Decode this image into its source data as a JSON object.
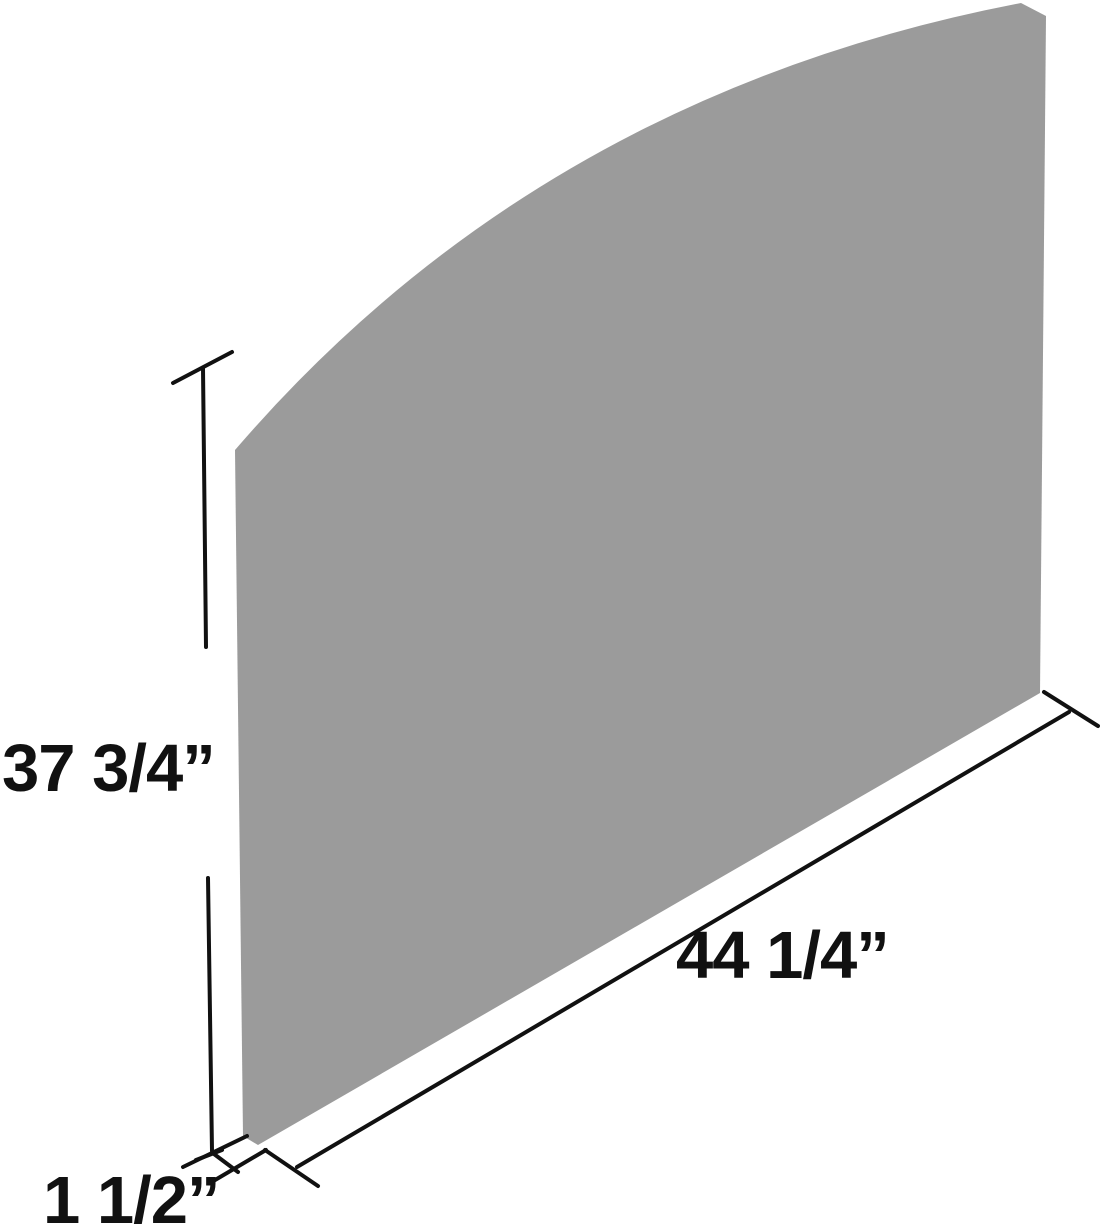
{
  "diagram": {
    "kind": "product-dimension-diagram",
    "subject": "flat panel with curved top shown in three-quarter perspective",
    "dimensions": {
      "height": {
        "label": "37 3/4”"
      },
      "width": {
        "label": "44 1/4”"
      },
      "depth": {
        "label": "1 1/2”"
      }
    },
    "colors": {
      "panel": "#9b9b9b",
      "line": "#111111",
      "text": "#111111",
      "background": "#ffffff"
    }
  }
}
